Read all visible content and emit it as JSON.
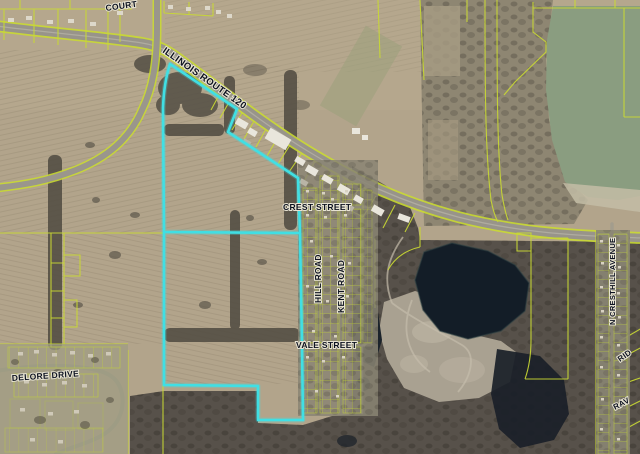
{
  "map": {
    "labels": {
      "route": "ILLINOIS ROUTE 120",
      "court": "COURT",
      "crest": "CREST STREET",
      "hill": "HILL ROAD",
      "kent": "KENT ROAD",
      "vale": "VALE STREET",
      "delore": "DELORE DRIVE",
      "cresthill": "N CRESTHILL AVENUE",
      "ridge_partial": "RID",
      "ravine_partial": "RAV"
    },
    "colors": {
      "parcel_line": "#c9d933",
      "highlight_boundary": "#40dfe4",
      "label_text": "#0d1220",
      "label_halo": "#e7e3d2",
      "road_surface": "#98948a",
      "farmland": "#b2a48b",
      "woods": "#57514a",
      "lake_green": "#8a9d80",
      "quarry_water": "#131d27",
      "gravel_pit": "#a9a191"
    }
  }
}
